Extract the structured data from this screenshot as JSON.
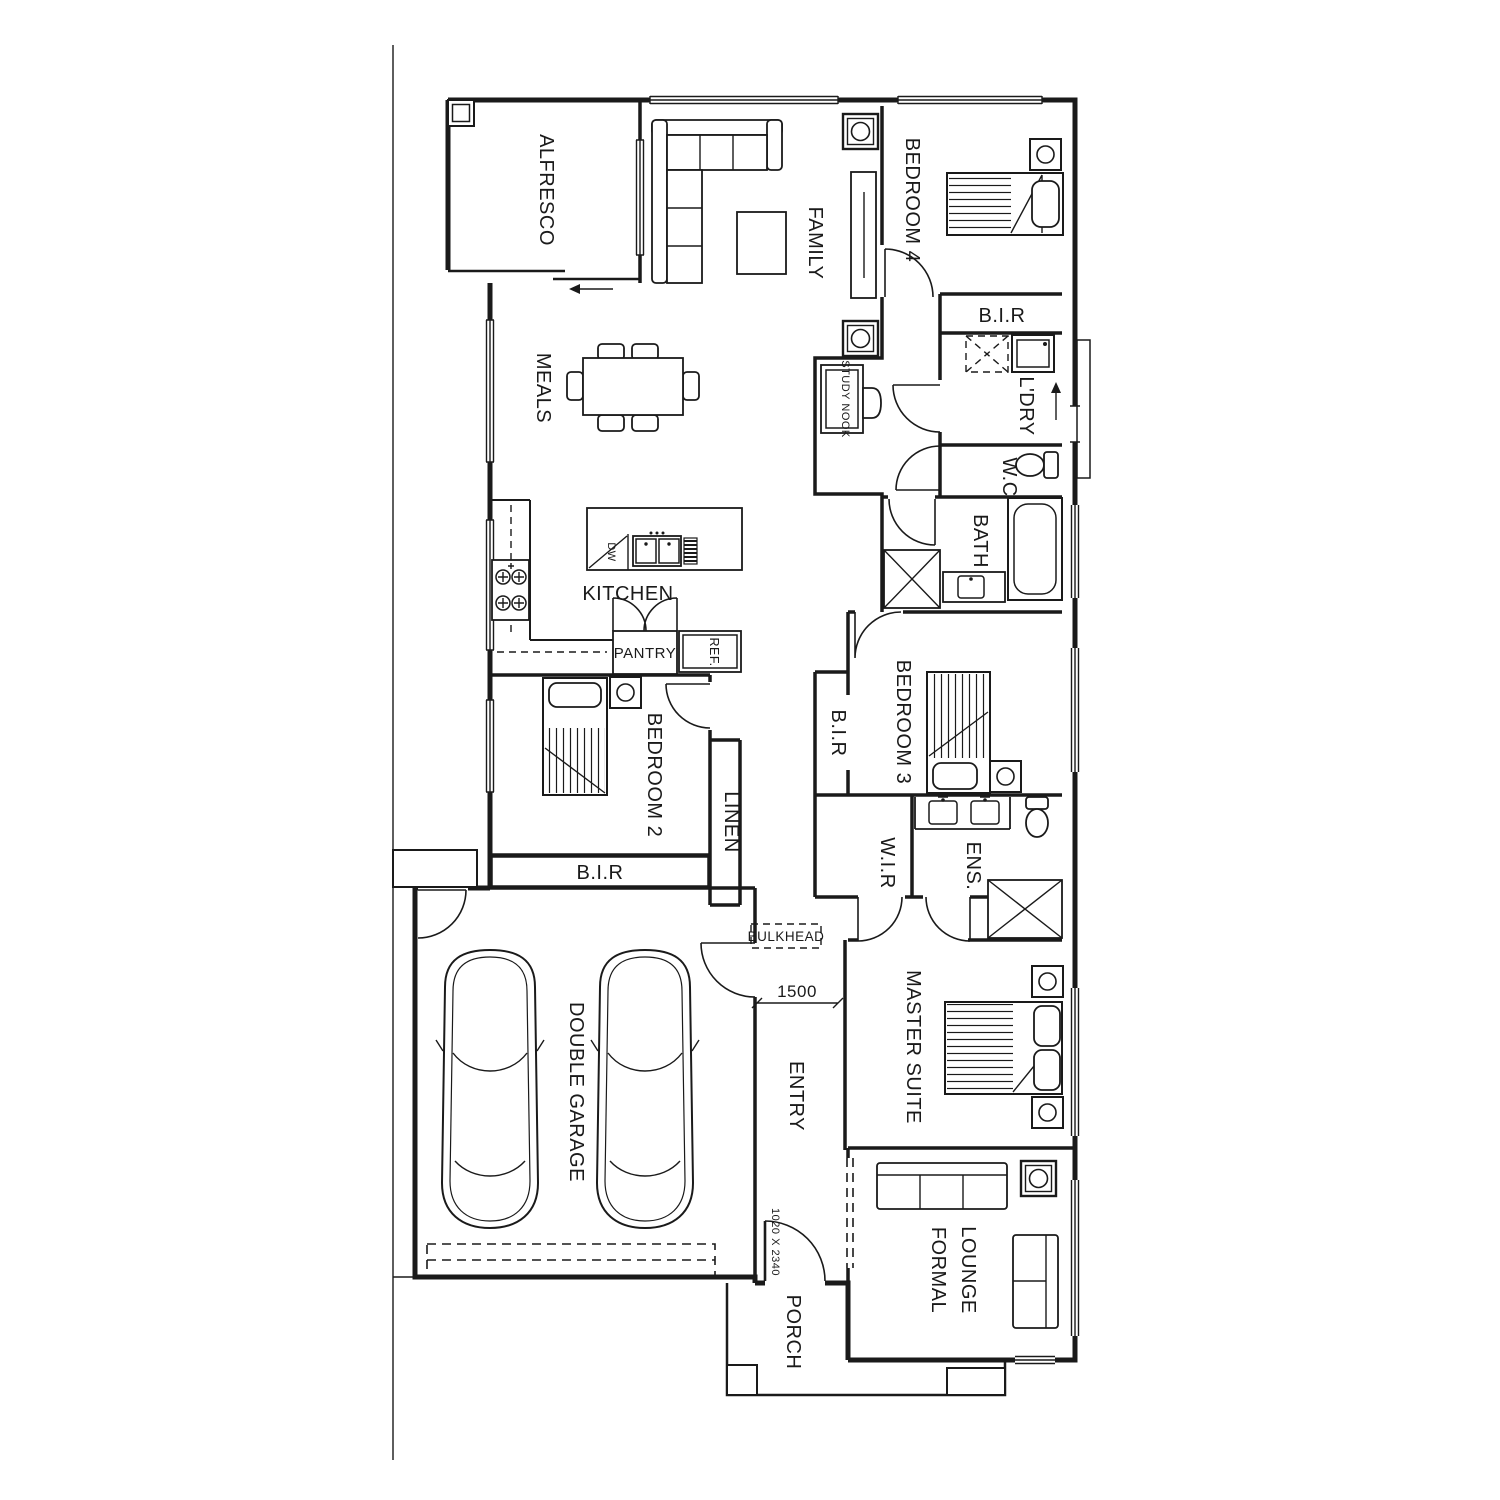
{
  "plan": {
    "colors": {
      "line": "#1a1a1a",
      "background": "#ffffff"
    },
    "labels": {
      "alfresco": "ALFRESCO",
      "family": "FAMILY",
      "bedroom4": "BEDROOM 4",
      "bir": "B.I.R",
      "ldry": "L'DRY",
      "wc": "W.C",
      "study_nook": "STUDY NOOK",
      "bath": "BATH",
      "meals": "MEALS",
      "kitchen": "KITCHEN",
      "pantry": "PANTRY",
      "ref": "REF.",
      "dw": "DW",
      "bedroom2": "BEDROOM 2",
      "linen": "LINEN",
      "bedroom3": "BEDROOM 3",
      "wir": "W.I.R",
      "ens": "ENS.",
      "bulkhead": "BULKHEAD",
      "garage": "DOUBLE GARAGE",
      "entry": "ENTRY",
      "master": "MASTER SUITE",
      "formal": "FORMAL",
      "lounge": "LOUNGE",
      "porch": "PORCH"
    },
    "dimensions": {
      "entry_width": "1500",
      "entry_door": "1020 X 2340"
    }
  }
}
